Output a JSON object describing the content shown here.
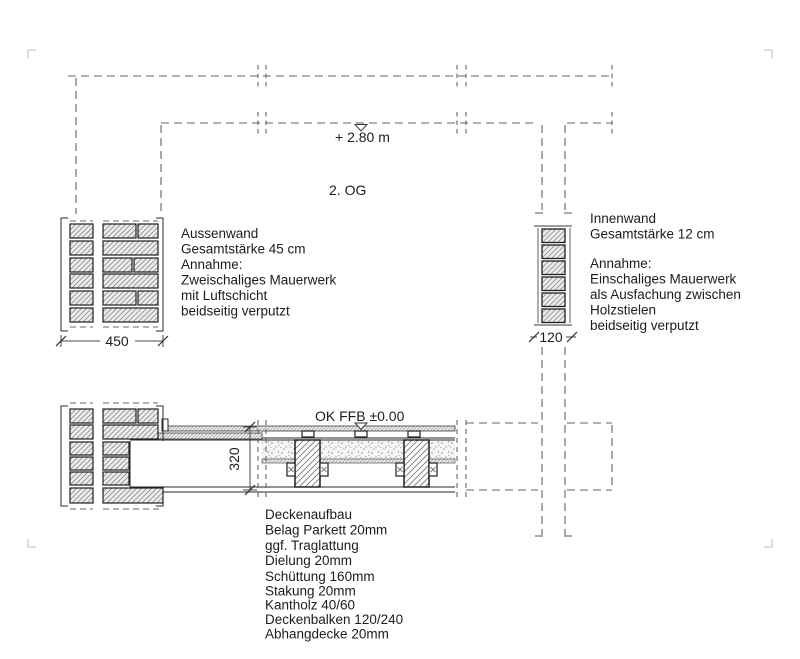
{
  "meta": {
    "storey_label": "2. OG",
    "upper_level": "+ 2.80 m",
    "floor_level": "OK FFB ±0.00"
  },
  "dimensions": {
    "aussenwand_width": "450",
    "innenwand_width": "120",
    "floor_thickness": "320"
  },
  "notes": {
    "aussenwand": {
      "lines": [
        "Aussenwand",
        "Gesamtstärke 45 cm",
        "Annahme:",
        "Zweischaliges Mauerwerk",
        "mit Luftschicht",
        "beidseitig verputzt"
      ]
    },
    "innenwand": {
      "lines": [
        "Innenwand",
        "Gesamtstärke 12 cm",
        "Annahme:",
        "Einschaliges Mauerwerk",
        "als Ausfachung zwischen",
        "Holzstielen",
        "beidseitig verputzt"
      ]
    },
    "deckenaufbau": {
      "lines": [
        "Deckenaufbau",
        "Belag Parkett  20mm",
        "ggf. Traglattung",
        "Dielung 20mm",
        "Schüttung 160mm",
        "Stakung 20mm",
        "Kantholz 40/60",
        "Deckenbalken 120/240",
        "Abhangdecke 20mm"
      ]
    }
  },
  "colors": {
    "line": "#1c1c1c",
    "dash": "#646464",
    "brick_fill": "#ececec",
    "hatch": "#8f8f8f",
    "corner_mark": "#c9c9c9",
    "background": "#ffffff"
  }
}
